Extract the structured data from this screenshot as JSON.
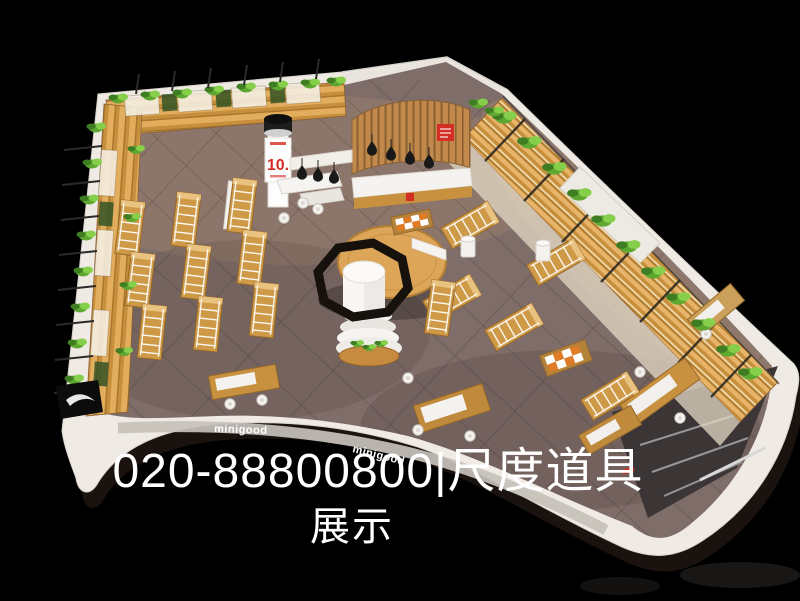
{
  "meta": {
    "description": "Aerial 3D render of an L-shaped minigood retail store with wooden wall shelving topped by green plants, rows of display gondolas, a central octagon-ring display with white cylinder, a curved wood cashier wall with black pendant lamps, and a white curved storefront fascia on a black background"
  },
  "watermark": {
    "line1": "020-88800800|尺度道具",
    "line2": "展示",
    "phone": "020-88800800",
    "separator": "|",
    "company": "尺度道具",
    "word": "展示",
    "color": "#ffffff"
  },
  "storefront": {
    "brand": "minigood"
  },
  "signs": {
    "column_banner": "10."
  },
  "palette": {
    "background": "#000000",
    "fascia_white": "#efebe4",
    "floor": "#7f6d69",
    "wood_light": "#e2ad5d",
    "wood_mid": "#c78f3c",
    "wood_dark": "#a9762d",
    "plant_green": "#86cf4a",
    "plant_green_dark": "#3f7d22",
    "accent_red": "#d42d24",
    "lamp_black": "#191919",
    "entrance_dark": "#3b3536"
  }
}
